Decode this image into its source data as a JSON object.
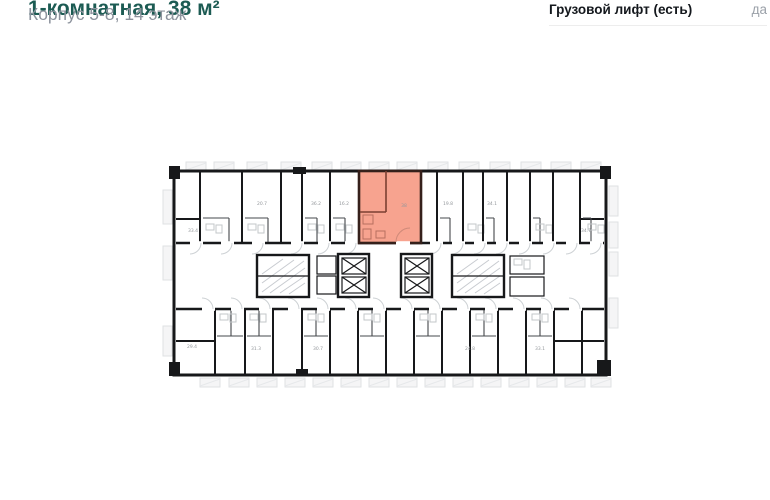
{
  "header": {
    "title": "1-комнатная, 38 м²",
    "subtitle": "Корпус 5-8, 14 этаж"
  },
  "specs": {
    "freight_elevator_label": "Грузовой лифт (есть)",
    "freight_elevator_value": "да"
  },
  "plan": {
    "highlight_color": "#f7a38f",
    "highlight_wall_color": "#35201b",
    "wall_color": "#17181a",
    "detail_color": "#cdd1d4",
    "hatch_color": "#c8cbd0",
    "room_labels": [
      {
        "text": "33.4",
        "x": 193,
        "y": 232
      },
      {
        "text": "20.7",
        "x": 262,
        "y": 205
      },
      {
        "text": "36.2",
        "x": 316,
        "y": 205
      },
      {
        "text": "16.2",
        "x": 344,
        "y": 205
      },
      {
        "text": "38",
        "x": 404,
        "y": 207
      },
      {
        "text": "19.8",
        "x": 448,
        "y": 205
      },
      {
        "text": "34.1",
        "x": 492,
        "y": 205
      },
      {
        "text": "34.7",
        "x": 586,
        "y": 232
      },
      {
        "text": "29.4",
        "x": 192,
        "y": 348
      },
      {
        "text": "31.3",
        "x": 256,
        "y": 350
      },
      {
        "text": "30.7",
        "x": 318,
        "y": 350
      },
      {
        "text": "24.8",
        "x": 470,
        "y": 350
      },
      {
        "text": "33.1",
        "x": 540,
        "y": 350
      }
    ]
  }
}
